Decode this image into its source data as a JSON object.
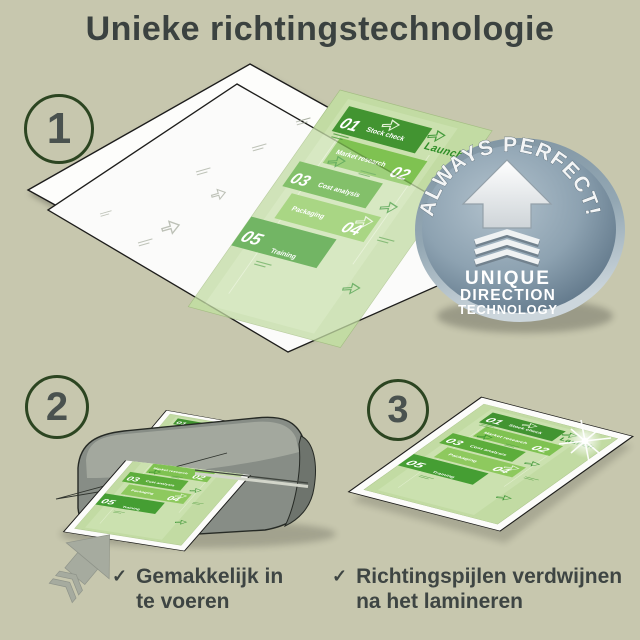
{
  "title": "Unieke richtingstechnologie",
  "steps": [
    "1",
    "2",
    "3"
  ],
  "badge": {
    "arc_text": "ALWAYS PERFECT!",
    "lines": [
      "UNIQUE",
      "DIRECTION",
      "TECHNOLOGY"
    ]
  },
  "document": {
    "launch_label": "Launch",
    "items": [
      {
        "num": "01",
        "label": "Stock check",
        "color": "#429431"
      },
      {
        "num": "02",
        "label": "Market research",
        "color": "#7fc251"
      },
      {
        "num": "03",
        "label": "Cost analysis",
        "color": "#5cad3b"
      },
      {
        "num": "04",
        "label": "Packaging",
        "color": "#8ec95e"
      },
      {
        "num": "05",
        "label": "Training",
        "color": "#459e33"
      }
    ]
  },
  "checklist": {
    "check_glyph": "✓",
    "items": [
      {
        "line1": "Gemakkelijk in",
        "line2": "te voeren"
      },
      {
        "line1": "Richtingspijlen verdwijnen",
        "line2": "na het lamineren"
      }
    ]
  },
  "colors": {
    "background": "#c7c7ae",
    "title_text": "#3b4240",
    "step_circle_border": "#2c4521",
    "doc_background": "#c2dba3",
    "doc_arrow_green": "#2f8f2a",
    "pouch_white": "#fbfbf9",
    "outline_dark": "#1d1d1b",
    "badge_metal_light": "#aebfcb",
    "badge_metal_dark": "#5a7184",
    "machine_gray": "#878d86",
    "feed_arrow_gray": "#a6ab9f"
  }
}
